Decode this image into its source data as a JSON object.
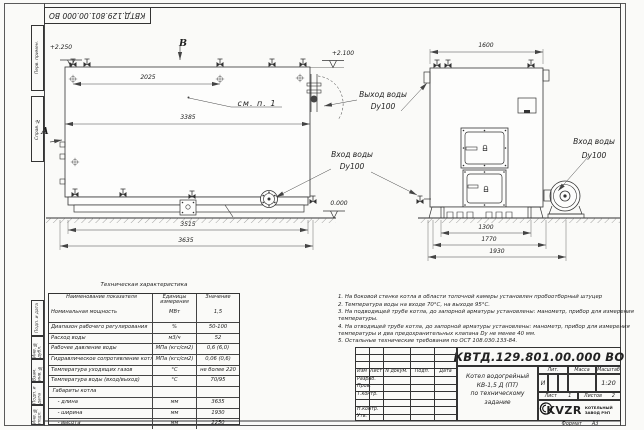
{
  "colors": {
    "paper": "#fafaf8",
    "ink": "#333333"
  },
  "sheet": {
    "designation": "КВТД.129.801.00.000 ВО",
    "format_label": "Формат",
    "format_value": "А3"
  },
  "margins": {
    "top_boxes": [
      "Перв. примен.",
      "Справ. №"
    ],
    "bottom_boxes": [
      "Подп. и дата",
      "Инв. № дубл.",
      "Взам. инв. №",
      "Подп. и дата",
      "Инв. № подл."
    ]
  },
  "views": {
    "side": {
      "label_b": "В",
      "label_a": "А",
      "callout": "см. п. 1",
      "elev_top_left": "+2.250",
      "elev_top_right": "+2.100",
      "elev_zero": "0.000",
      "dims": {
        "top": "2025",
        "mid": "3385",
        "bottom1": "3515",
        "bottom2": "3635"
      }
    },
    "front": {
      "dims": {
        "top": "1600",
        "b1": "1300",
        "b2": "1770",
        "b3": "1930"
      }
    },
    "ports": {
      "outlet_line1": "Выход воды",
      "outlet_line2": "Dy100",
      "inlet_left_line1": "Вход воды",
      "inlet_left_line2": "Dy100",
      "inlet_right_line1": "Вход воды",
      "inlet_right_line2": "Dy100"
    }
  },
  "spec_table": {
    "title": "Техническая характеристика",
    "headers": [
      "Наименование показателя",
      "Единицы измерения",
      "Значение"
    ],
    "rows": [
      {
        "name": "Номинальная мощность",
        "unit": "МВт",
        "value": "1,5"
      },
      {
        "name": "Диапазон рабочего регулирования",
        "unit": "%",
        "value": "50-100"
      },
      {
        "name": "Расход воды",
        "unit": "м3/ч",
        "value": "52"
      },
      {
        "name": "Рабочее давление воды",
        "unit": "МПа (кгс/см2)",
        "value": "0,6 (6,0)"
      },
      {
        "name": "Гидравлическое сопротивление котла",
        "unit": "МПа (кгс/см2)",
        "value": "0,06 (0,6)"
      },
      {
        "name": "Температура уходящих газов",
        "unit": "°С",
        "value": "не более 220"
      },
      {
        "name": "Температура воды (вход/выход)",
        "unit": "°С",
        "value": "70/95"
      },
      {
        "name": " Габариты котла",
        "unit": "",
        "value": ""
      },
      {
        "name": "    - длина",
        "unit": "мм",
        "value": "3635"
      },
      {
        "name": "    - ширина",
        "unit": "мм",
        "value": "1930"
      },
      {
        "name": "    - высота",
        "unit": "мм",
        "value": "2250"
      }
    ]
  },
  "notes": [
    "1. На боковой стенке котла в области топочной камеры установлен пробоотборный штуцер",
    "2. Температура воды на входе 70°С, на выходе 95°С.",
    "3. На подводящей трубе котла, до запорной арматуры установлены: манометр, прибор для измерения температуры.",
    "4. На отводящей трубе котла, до запорной арматуры установлены: манометр, прибор для измерения температуры и два предохранительных клапана Dу не менее 40 мм.",
    "5. Остальные технические требования по ОСТ 108.030.133-84."
  ],
  "title_block": {
    "designation": "КВТД.129.801.00.000 ВО",
    "product_line1": "Котел водогрейный",
    "product_line2": "КВ-1,5 Д (ПТ)",
    "product_line3": "по техническому задание",
    "header_cols": [
      "Изм",
      "Лист",
      "N докум.",
      "Подп.",
      "Дата"
    ],
    "sig_rows": [
      "Разраб.",
      "Пров.",
      "Т.контр.",
      "",
      "Н.контр.",
      "Утв."
    ],
    "lit_label": "Лит.",
    "lit_value": "И",
    "mass_label": "Масса",
    "scale_label": "Масштаб",
    "scale_value": "1:20",
    "sheet_label": "Лист",
    "sheet_value": "1",
    "sheets_label": "Листов",
    "sheets_value": "2",
    "logo_text": "KVZR",
    "logo_caption_line1": "КОТЕЛЬНЫЙ",
    "logo_caption_line2": "ЗАВОД РЭП"
  }
}
